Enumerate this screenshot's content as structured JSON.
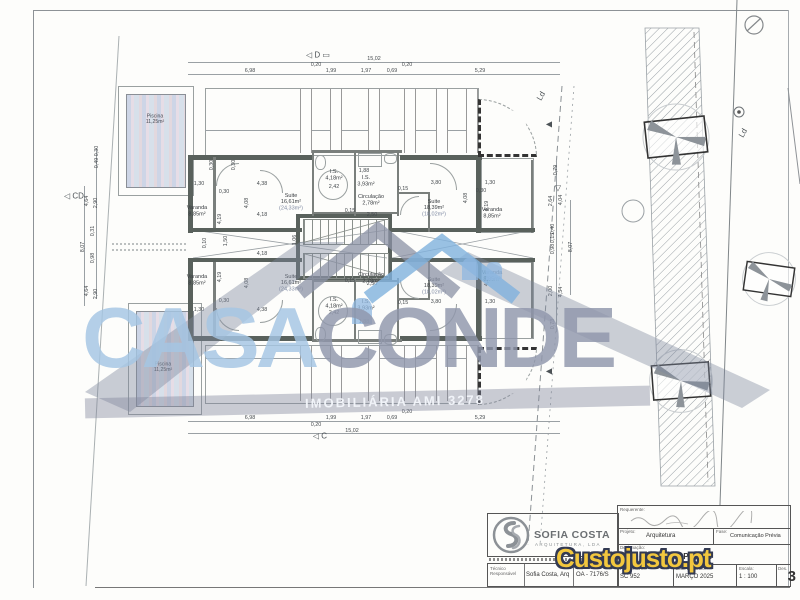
{
  "colors": {
    "watermark_blue": "#a5c6e4",
    "watermark_gray": "#9097ac",
    "custojusto_yellow": "#f2c73e",
    "custojusto_outline": "#333a52",
    "wall_dark": "#59615c"
  },
  "watermark": {
    "casa": "CASA",
    "conde": "CONDE",
    "subtitle": "IMOBILIÁRIA AMI 3278"
  },
  "custojusto": {
    "text": "Custojusto.pt"
  },
  "titleblock": {
    "firm_name": "SOFIA COSTA",
    "firm_sub": "ARQUITETURA, LDA",
    "tecnico_label": "Técnico Responsável",
    "tecnico_value": "Sofia Costa, Arq",
    "oa_value": "OA - 7176/S",
    "requerente_label": "Requerente:",
    "projeto_label": "Projeto:",
    "projeto_value": "Arquitetura",
    "fase_label": "Fase:",
    "fase_value": "Comunicação Prévia",
    "designacao_label": "Designação:",
    "designacao_value": "PLANTA PISO 1",
    "proc_label": "Proc. Interno:",
    "proc_value": "SC 952",
    "data_label": "Data Desenho:",
    "data_value": "MARÇO 2025",
    "escala_label": "Escala:",
    "escala_value": "1 : 100",
    "desenho_label": "Des.",
    "desenho_value": "3"
  },
  "plan": {
    "rooms": [
      {
        "name": "Varanda",
        "area": "8,85m²",
        "x": 197,
        "y": 212
      },
      {
        "name": "Suite",
        "area": "16,61m²",
        "area2": "(24,33m²)",
        "x": 291,
        "y": 203
      },
      {
        "name": "I.S.",
        "area": "4,18m²",
        "x": 334,
        "y": 176
      },
      {
        "name": "I.S.",
        "area": "3,93m²",
        "x": 366,
        "y": 182
      },
      {
        "name": "Circulação",
        "area": "2,78m²",
        "x": 371,
        "y": 201
      },
      {
        "name": "Suite",
        "area": "18,39m²",
        "area2": "(18,02m²)",
        "x": 434,
        "y": 209
      },
      {
        "name": "Varanda",
        "area": "8,85m²",
        "x": 492,
        "y": 214
      },
      {
        "name": "Varanda",
        "area": "8,85m²",
        "x": 197,
        "y": 281
      },
      {
        "name": "Suite",
        "area": "16,61m²",
        "area2": "(24,33m²)",
        "x": 291,
        "y": 284
      },
      {
        "name": "I.S.",
        "area": "4,18m²",
        "x": 334,
        "y": 304
      },
      {
        "name": "I.S.",
        "area": "3,93m²",
        "x": 366,
        "y": 306
      },
      {
        "name": "Circulação",
        "area": "2,78m²",
        "x": 371,
        "y": 279
      },
      {
        "name": "Suite",
        "area": "18,39m²",
        "area2": "(18,02m²)",
        "x": 434,
        "y": 287
      },
      {
        "name": "Varanda",
        "area": "8,85m²",
        "x": 492,
        "y": 277
      }
    ],
    "pools": [
      {
        "name": "Piscina",
        "area": "11,25m²",
        "x": 155,
        "y": 120
      },
      {
        "name": "Piscina",
        "area": "11,25m²",
        "x": 163,
        "y": 368
      }
    ],
    "dimensions": [
      {
        "t": "15,02",
        "x": 374,
        "y": 59,
        "r": 0
      },
      {
        "t": "6,98",
        "x": 250,
        "y": 71,
        "r": 0
      },
      {
        "t": "0,20",
        "x": 316,
        "y": 65,
        "r": 0
      },
      {
        "t": "1,99",
        "x": 331,
        "y": 71,
        "r": 0
      },
      {
        "t": "1,97",
        "x": 366,
        "y": 71,
        "r": 0
      },
      {
        "t": "0,69",
        "x": 392,
        "y": 71,
        "r": 0
      },
      {
        "t": "0,20",
        "x": 407,
        "y": 65,
        "r": 0
      },
      {
        "t": "5,29",
        "x": 480,
        "y": 71,
        "r": 0
      },
      {
        "t": "6,98",
        "x": 250,
        "y": 418,
        "r": 0
      },
      {
        "t": "0,20",
        "x": 316,
        "y": 425,
        "r": 0
      },
      {
        "t": "1,99",
        "x": 331,
        "y": 418,
        "r": 0
      },
      {
        "t": "1,97",
        "x": 366,
        "y": 418,
        "r": 0
      },
      {
        "t": "0,69",
        "x": 392,
        "y": 418,
        "r": 0
      },
      {
        "t": "0,20",
        "x": 407,
        "y": 412,
        "r": 0
      },
      {
        "t": "5,29",
        "x": 480,
        "y": 418,
        "r": 0
      },
      {
        "t": "15,02",
        "x": 352,
        "y": 431,
        "r": 0
      },
      {
        "t": "0,30",
        "x": 97,
        "y": 151,
        "r": -90
      },
      {
        "t": "0,49",
        "x": 97,
        "y": 163,
        "r": -90
      },
      {
        "t": "4,64",
        "x": 87,
        "y": 201,
        "r": -90
      },
      {
        "t": "2,90",
        "x": 96,
        "y": 203,
        "r": -90
      },
      {
        "t": "0,31",
        "x": 93,
        "y": 231,
        "r": -90
      },
      {
        "t": "8,07",
        "x": 83,
        "y": 247,
        "r": -90
      },
      {
        "t": "0,98",
        "x": 93,
        "y": 258,
        "r": -90
      },
      {
        "t": "4,64",
        "x": 87,
        "y": 291,
        "r": -90
      },
      {
        "t": "2,90",
        "x": 96,
        "y": 294,
        "r": -90
      },
      {
        "t": "0,79",
        "x": 556,
        "y": 170,
        "r": -90
      },
      {
        "t": "2,64",
        "x": 551,
        "y": 201,
        "r": -90
      },
      {
        "t": "4,04",
        "x": 561,
        "y": 200,
        "r": -90
      },
      {
        "t": "0,40",
        "x": 553,
        "y": 229,
        "r": -90
      },
      {
        "t": "0,15",
        "x": 553,
        "y": 238,
        "r": -90
      },
      {
        "t": "0,98",
        "x": 553,
        "y": 249,
        "r": -90
      },
      {
        "t": "8,07",
        "x": 571,
        "y": 247,
        "r": -90
      },
      {
        "t": "2,00",
        "x": 551,
        "y": 291,
        "r": -90
      },
      {
        "t": "4,54",
        "x": 561,
        "y": 292,
        "r": -90
      },
      {
        "t": "0,73",
        "x": 553,
        "y": 324,
        "r": -90
      },
      {
        "t": "0,30",
        "x": 212,
        "y": 165,
        "r": -90
      },
      {
        "t": "0,30",
        "x": 234,
        "y": 165,
        "r": -90
      },
      {
        "t": "1,30",
        "x": 199,
        "y": 184,
        "r": 0
      },
      {
        "t": "4,38",
        "x": 262,
        "y": 184,
        "r": 0
      },
      {
        "t": "0,30",
        "x": 224,
        "y": 192,
        "r": 0
      },
      {
        "t": "4,19",
        "x": 220,
        "y": 219,
        "r": -90
      },
      {
        "t": "4,08",
        "x": 247,
        "y": 203,
        "r": -90
      },
      {
        "t": "4,18",
        "x": 262,
        "y": 215,
        "r": 0
      },
      {
        "t": "2,42",
        "x": 334,
        "y": 187,
        "r": 0
      },
      {
        "t": "1,88",
        "x": 364,
        "y": 171,
        "r": 0
      },
      {
        "t": "0,15",
        "x": 350,
        "y": 211,
        "r": 0
      },
      {
        "t": "2,50",
        "x": 372,
        "y": 215,
        "r": 0
      },
      {
        "t": "0,15",
        "x": 403,
        "y": 189,
        "r": 0
      },
      {
        "t": "3,80",
        "x": 436,
        "y": 183,
        "r": 0
      },
      {
        "t": "1,30",
        "x": 490,
        "y": 183,
        "r": 0
      },
      {
        "t": "0,30",
        "x": 481,
        "y": 191,
        "r": 0
      },
      {
        "t": "4,19",
        "x": 487,
        "y": 206,
        "r": -90
      },
      {
        "t": "4,08",
        "x": 466,
        "y": 198,
        "r": -90
      },
      {
        "t": "0,10",
        "x": 205,
        "y": 243,
        "r": -90
      },
      {
        "t": "1,50",
        "x": 226,
        "y": 241,
        "r": -90
      },
      {
        "t": "1,06",
        "x": 295,
        "y": 240,
        "r": -90
      },
      {
        "t": "4,18",
        "x": 262,
        "y": 254,
        "r": 0
      },
      {
        "t": "4,19",
        "x": 220,
        "y": 277,
        "r": -90
      },
      {
        "t": "0,15",
        "x": 350,
        "y": 281,
        "r": 0
      },
      {
        "t": "2,50",
        "x": 372,
        "y": 284,
        "r": 0
      },
      {
        "t": "2,42",
        "x": 334,
        "y": 313,
        "r": 0
      },
      {
        "t": "1,88",
        "x": 364,
        "y": 322,
        "r": 0
      },
      {
        "t": "0,15",
        "x": 403,
        "y": 303,
        "r": 0
      },
      {
        "t": "3,80",
        "x": 436,
        "y": 302,
        "r": 0
      },
      {
        "t": "1,30",
        "x": 490,
        "y": 302,
        "r": 0
      },
      {
        "t": "4,19",
        "x": 487,
        "y": 281,
        "r": -90
      },
      {
        "t": "1,30",
        "x": 199,
        "y": 310,
        "r": 0
      },
      {
        "t": "4,38",
        "x": 262,
        "y": 310,
        "r": 0
      },
      {
        "t": "0,30",
        "x": 224,
        "y": 301,
        "r": 0
      },
      {
        "t": "4,08",
        "x": 247,
        "y": 283,
        "r": -90
      }
    ],
    "markers": [
      {
        "glyph": "◁",
        "label": "D ▭",
        "x": 318,
        "y": 55,
        "r": 0
      },
      {
        "glyph": "◁",
        "label": "C",
        "x": 320,
        "y": 436,
        "r": 0
      },
      {
        "glyph": "◁",
        "label": "CD",
        "x": 74,
        "y": 196,
        "r": 0
      },
      {
        "glyph": "",
        "label": "Ld",
        "x": 541,
        "y": 96,
        "r": -60
      },
      {
        "glyph": "",
        "label": "Ld",
        "x": 743,
        "y": 133,
        "r": -60
      },
      {
        "glyph": "▽",
        "label": "",
        "x": 558,
        "y": 188,
        "r": 0
      },
      {
        "glyph": "◀",
        "label": "",
        "x": 549,
        "y": 124,
        "r": 0
      },
      {
        "glyph": "◀",
        "label": "",
        "x": 549,
        "y": 371,
        "r": 0
      }
    ]
  }
}
